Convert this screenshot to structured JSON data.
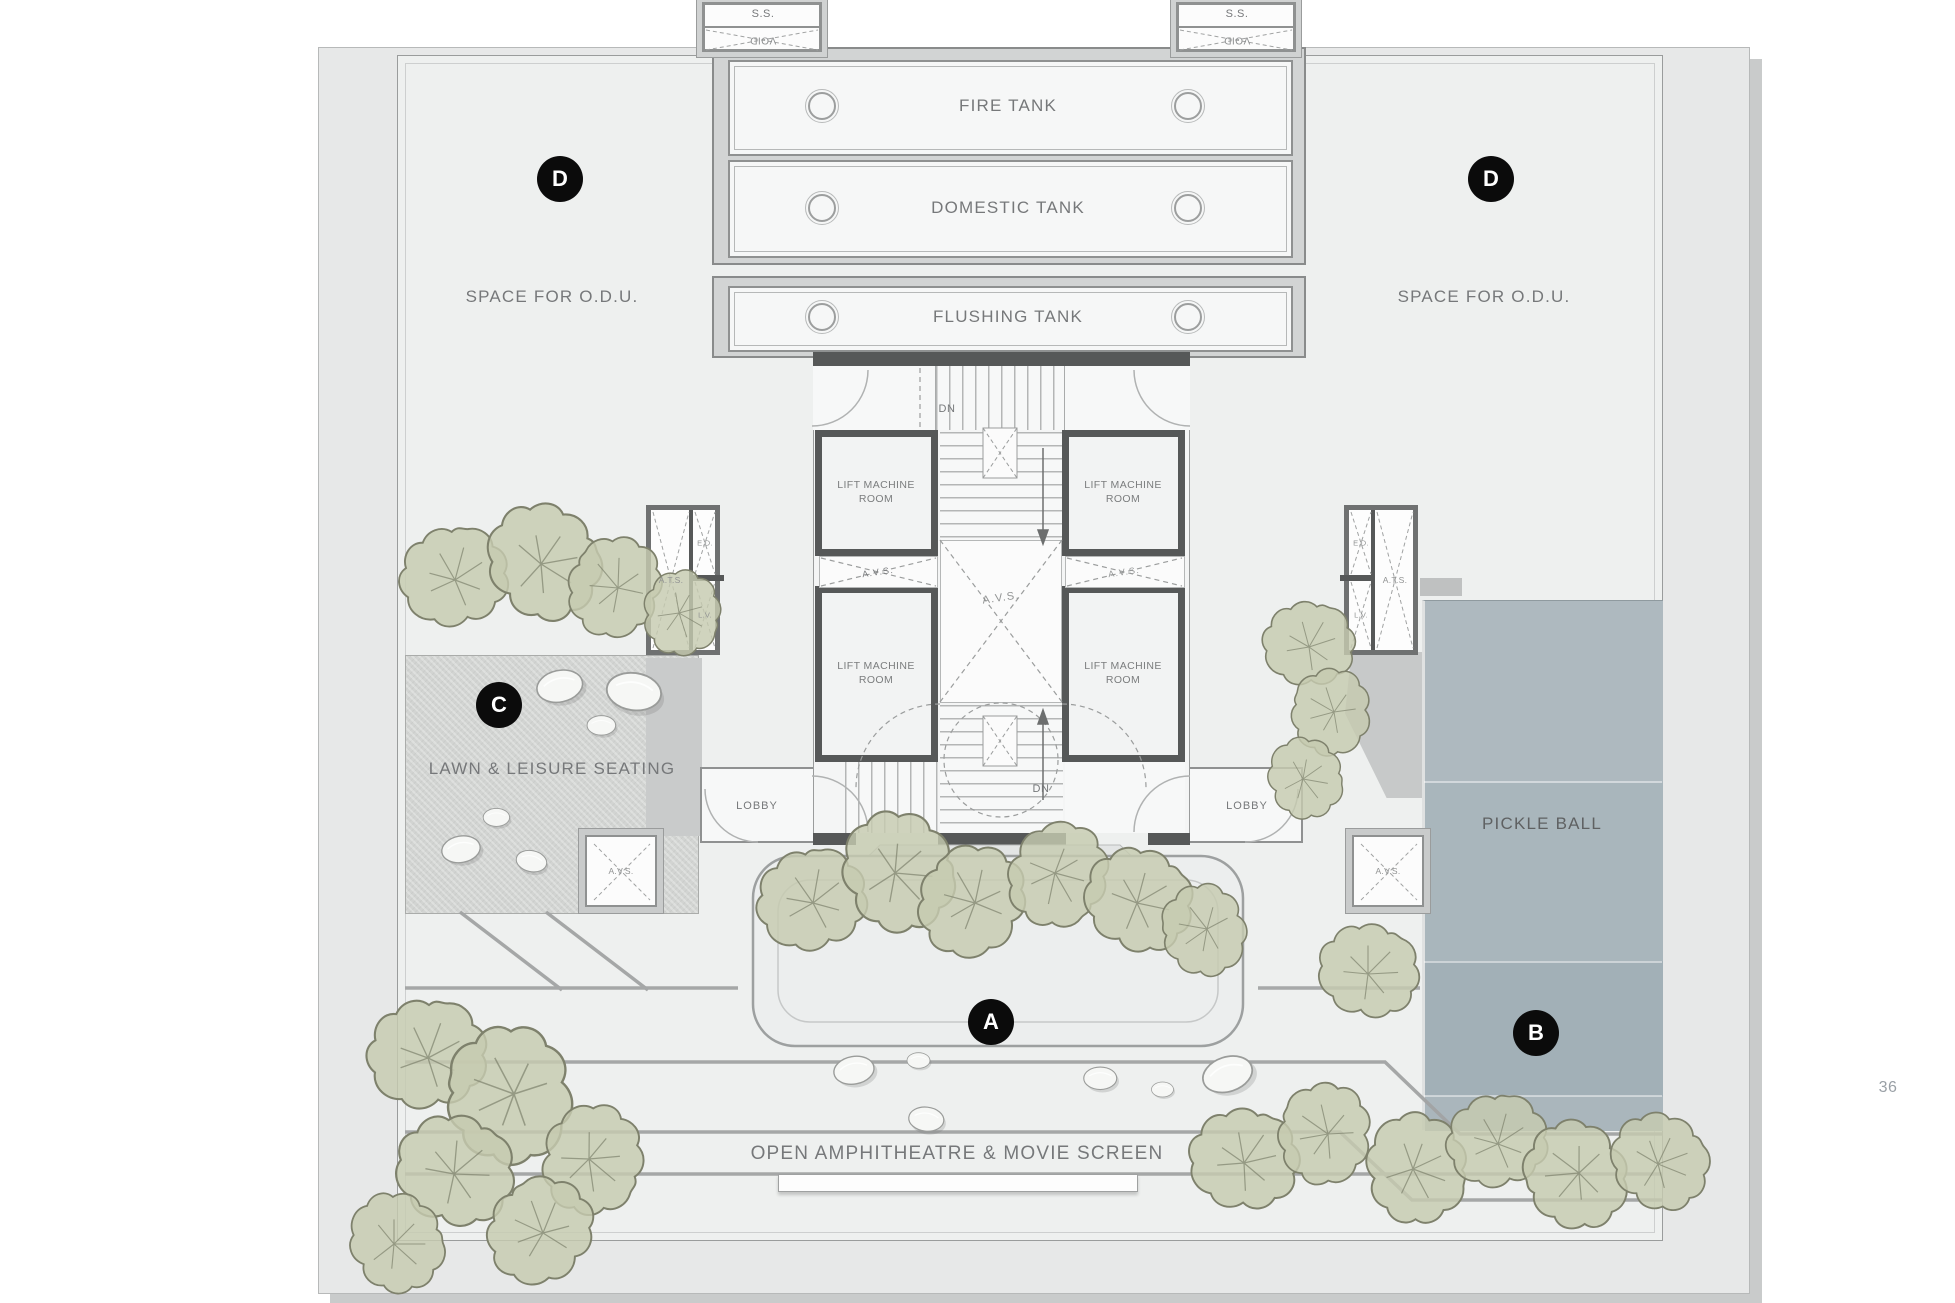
{
  "page": {
    "number": "36"
  },
  "plan": {
    "tanks": {
      "fire": "FIRE TANK",
      "domestic": "DOMESTIC TANK",
      "flushing": "FLUSHING TANK"
    },
    "shaft_labels": {
      "ss": "S.S.",
      "void": "VOID",
      "avs": "A.V.S.",
      "ats": "A.T.S.",
      "ed": "E.D.",
      "lv": "L.V."
    },
    "core": {
      "lift_machine_room": "LIFT MACHINE ROOM",
      "down": "DN",
      "lobby": "LOBBY"
    },
    "areas": {
      "odu": "SPACE FOR O.D.U.",
      "lawn": "LAWN & LEISURE SEATING",
      "pickle_ball": "PICKLE BALL",
      "amphitheatre": "OPEN AMPHITHEATRE & MOVIE SCREEN"
    },
    "markers": {
      "a": "A",
      "b": "B",
      "c": "C",
      "d": "D"
    },
    "colors": {
      "court": "#a9b6bc",
      "tree": "#c6cab0",
      "wall": "#565858",
      "marker": "#0b0b0b",
      "deck": "#eef0ef",
      "slab": "#e7e8e8",
      "lawn": "#d2d4d2",
      "text": "#76787a"
    }
  }
}
